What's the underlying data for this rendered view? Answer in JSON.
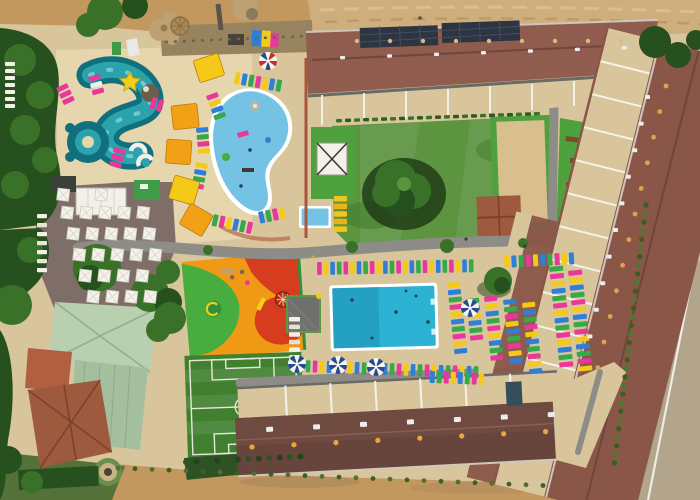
{
  "meta": {
    "title": "Aerial drone view of a holiday resort with water park, pools, playground, football pitch and apartment blocks",
    "view": "top-down"
  },
  "palette": {
    "sand": "#d9c59c",
    "sandlight": "#e6d6ae",
    "dirt": "#c2985f",
    "dirtlight": "#cfae7e",
    "scrub": "#55713a",
    "road": "#b3a48c",
    "path": "#8d8c86",
    "pave": "#7f6d68",
    "lawn": "#5d9440",
    "lawndark": "#3f7a2c",
    "turf": "#4fa13e",
    "pitch": "#40802f",
    "treedark": "#27501f",
    "treemid": "#3a7128",
    "shrub": "#3f6b2f",
    "riverdark": "#11707e",
    "river": "#2ba3ad",
    "riverlight": "#7fd0d6",
    "kidspool": "#74c2e4",
    "mainpool": "#2cb3d4",
    "mainpooldark": "#1f97b8",
    "rooftop": "#8f5c4d",
    "roofbottom": "#6f4a40",
    "roofright": "#8a5648",
    "roofpale1": "#b9d0b0",
    "roofpale2": "#a4bf9e",
    "rooftile": "#9d5a3e",
    "terracotta": "#b06040",
    "courttan": "#d9bf8e",
    "solar": "#2e3542",
    "playorange": "#ef9915",
    "playred": "#d63c1e",
    "playgreen": "#47ad3e",
    "white1": "#f2f0e8",
    "gray1": "#9a978f",
    "dark1": "#4a463e",
    "rock": "#bda173",
    "loungerpink": "#e8399b",
    "loungeryellow": "#f4c918",
    "loungerblue": "#2f7fd6",
    "loungergreen": "#35a94c",
    "umbrellaorange": "#f2a117",
    "pinwheelnavy": "#274b8f",
    "candyred": "#c42e2e"
  },
  "furniture": {
    "colors": [
      "#e8399b",
      "#f4c918",
      "#2f7fd6",
      "#35a94c"
    ],
    "strips": [
      {
        "name": "pool-top-row",
        "x": 317,
        "y": 262,
        "dx": 6.6,
        "count": 24,
        "w": 4.6,
        "h": 13,
        "rot": -1
      },
      {
        "name": "pool-bottom-row",
        "x": 299,
        "y": 360,
        "dx": 7,
        "count": 26,
        "w": 4.6,
        "h": 12,
        "rot": 2,
        "off": 2
      },
      {
        "name": "deck-east-col-1",
        "x": 447,
        "y": 283,
        "dy": 7.4,
        "count": 10,
        "w": 13,
        "h": 5,
        "rot": -6,
        "off": 1
      },
      {
        "name": "deck-east-col-2",
        "x": 466,
        "y": 299,
        "dy": 7.4,
        "count": 6,
        "w": 13,
        "h": 5,
        "rot": -6,
        "off": 3
      },
      {
        "name": "deck-east-col-3",
        "x": 484,
        "y": 297,
        "dy": 7.4,
        "count": 9,
        "w": 13,
        "h": 5,
        "rot": -6
      },
      {
        "name": "deck-east-col-4",
        "x": 503,
        "y": 300,
        "dy": 7.4,
        "count": 9,
        "w": 13,
        "h": 5,
        "rot": -6,
        "off": 2
      },
      {
        "name": "deck-east-col-5",
        "x": 522,
        "y": 303,
        "dy": 7.4,
        "count": 10,
        "w": 13,
        "h": 5,
        "rot": -6,
        "off": 1
      },
      {
        "name": "deck-east-col-6",
        "x": 549,
        "y": 267,
        "dy": 7.4,
        "count": 14,
        "w": 14,
        "h": 5,
        "rot": -6,
        "off": 3
      },
      {
        "name": "deck-east-col-7",
        "x": 568,
        "y": 271,
        "dy": 7.4,
        "count": 14,
        "w": 14,
        "h": 5,
        "rot": -6
      },
      {
        "name": "deck-east-top-row",
        "x": 504,
        "y": 256,
        "dx": 7.2,
        "count": 10,
        "w": 5,
        "h": 12,
        "rot": -3,
        "off": 1
      },
      {
        "name": "deck-southeast-row",
        "x": 430,
        "y": 371,
        "dx": 7,
        "count": 8,
        "w": 5,
        "h": 12,
        "rot": 2,
        "off": 2
      },
      {
        "name": "pool-west-white-col",
        "x": 289,
        "y": 317,
        "dy": 7.6,
        "count": 7,
        "w": 11,
        "h": 4.5,
        "colors": [
          "#f3f0e7",
          "#e4e0d2"
        ]
      },
      {
        "name": "toddler-pool-loungers",
        "x": 334,
        "y": 196,
        "dy": 7.6,
        "count": 5,
        "w": 13,
        "h": 5.5,
        "colors": [
          "#f2c41c",
          "#e9b514"
        ]
      },
      {
        "name": "kids-pool-top-arc",
        "x": 236,
        "y": 72,
        "dx": 7,
        "count": 7,
        "w": 5,
        "h": 12,
        "rot": 10,
        "off": 1
      },
      {
        "name": "kids-pool-left-arc-1",
        "x": 206,
        "y": 96,
        "dy": 7,
        "count": 4,
        "w": 12,
        "h": 5,
        "rot": -20
      },
      {
        "name": "kids-pool-left-arc-2",
        "x": 196,
        "y": 128,
        "dy": 7,
        "count": 4,
        "w": 12,
        "h": 5,
        "rot": -5,
        "off": 2
      },
      {
        "name": "kids-pool-left-arc-3",
        "x": 196,
        "y": 162,
        "dy": 7,
        "count": 4,
        "w": 12,
        "h": 5,
        "rot": 10,
        "off": 1
      },
      {
        "name": "kids-pool-bottom-arc",
        "x": 214,
        "y": 214,
        "dx": 7,
        "count": 6,
        "w": 5,
        "h": 12,
        "rot": 12,
        "off": 3
      },
      {
        "name": "kids-pool-bottom-arc-2",
        "x": 258,
        "y": 212,
        "dx": 7,
        "count": 4,
        "w": 5,
        "h": 12,
        "rot": -12,
        "off": 2
      },
      {
        "name": "waterpark-loungers-1",
        "x": 56,
        "y": 88,
        "dy": 7,
        "count": 3,
        "w": 12,
        "h": 5,
        "rot": -25,
        "colors": [
          "#e8399b"
        ]
      },
      {
        "name": "waterpark-loungers-2",
        "x": 88,
        "y": 77,
        "dy": 7,
        "count": 3,
        "w": 12,
        "h": 5,
        "rot": -15,
        "colors": [
          "#e8399b",
          "#f3f0e7"
        ]
      },
      {
        "name": "waterpark-loungers-3",
        "x": 114,
        "y": 147,
        "dy": 7,
        "count": 3,
        "w": 12,
        "h": 5,
        "rot": 15,
        "colors": [
          "#e8399b"
        ]
      },
      {
        "name": "waterpark-loungers-4",
        "x": 149,
        "y": 108,
        "dy": 7,
        "count": 2,
        "w": 12,
        "h": 5,
        "rot": -70,
        "colors": [
          "#e8399b"
        ]
      },
      {
        "name": "westside-white-col",
        "x": 5,
        "y": 62,
        "dy": 7,
        "count": 7,
        "w": 10,
        "h": 4,
        "colors": [
          "#f3f0e7"
        ]
      },
      {
        "name": "terrace-sunbed-col",
        "x": 37,
        "y": 214,
        "dy": 9,
        "count": 7,
        "w": 10,
        "h": 4.2,
        "colors": [
          "#f3f0e7",
          "#e8e4d6"
        ]
      },
      {
        "name": "lawn-hedge-row",
        "x": 336,
        "y": 119,
        "dx": 9,
        "count": 23,
        "w": 6,
        "h": 3.5,
        "rot": -2,
        "colors": [
          "#3a7128",
          "#2c5a20"
        ]
      },
      {
        "name": "vents-north",
        "x": 357,
        "y": 41,
        "dx": 33,
        "count": 9,
        "r": 2.2,
        "colors": [
          "#d9b97c"
        ]
      },
      {
        "name": "ac-units-north",
        "x": 340,
        "y": 56,
        "dx": 47,
        "count": 7,
        "w": 5,
        "h": 3.4,
        "rot": -2,
        "colors": [
          "#ececec"
        ]
      },
      {
        "name": "vents-south",
        "x": 252,
        "y": 447,
        "dx": 42,
        "count": 8,
        "r": 2.6,
        "rot": -3,
        "colors": [
          "#e8a83c"
        ]
      },
      {
        "name": "ac-units-south",
        "x": 266,
        "y": 427,
        "dx": 47,
        "count": 7,
        "w": 7,
        "h": 5,
        "rot": -3,
        "colors": [
          "#ececec"
        ]
      },
      {
        "name": "vents-east",
        "x": 666,
        "y": 86,
        "dx": -6.2,
        "dy": 25.6,
        "count": 12,
        "r": 2.4,
        "colors": [
          "#e0a34c"
        ]
      },
      {
        "name": "ac-units-east",
        "x": 645,
        "y": 95,
        "dx": -6.4,
        "dy": 26.6,
        "count": 10,
        "w": 5,
        "h": 4,
        "colors": [
          "#ececec"
        ]
      },
      {
        "name": "scrub-dots-south",
        "x": 118,
        "y": 468,
        "dx": 17,
        "dy": 0.7,
        "count": 26,
        "r": 2.4,
        "colors": [
          "#4f6f36",
          "#3f5c2b"
        ]
      },
      {
        "name": "shrub-dots-east",
        "x": 646,
        "y": 205,
        "dx": -1.05,
        "dy": 8.6,
        "count": 31,
        "r": 2.6,
        "colors": [
          "#35601f",
          "#4a7a30"
        ]
      },
      {
        "name": "pitch-hedge-dots",
        "x": 186,
        "y": 462,
        "dx": 10.4,
        "dy": -0.5,
        "count": 12,
        "r": 3,
        "colors": [
          "#2e5223",
          "#24451b"
        ]
      }
    ],
    "canopies": [
      {
        "x": 193,
        "y": 61,
        "w": 26,
        "h": 23,
        "rot": -18,
        "color": "#f4c918"
      },
      {
        "x": 171,
        "y": 106,
        "w": 26,
        "h": 24,
        "rot": -6,
        "color": "#f2a117"
      },
      {
        "x": 167,
        "y": 139,
        "w": 25,
        "h": 24,
        "rot": 4,
        "color": "#f2a117"
      },
      {
        "x": 175,
        "y": 175,
        "w": 26,
        "h": 24,
        "rot": 16,
        "color": "#f4c918"
      },
      {
        "x": 191,
        "y": 203,
        "w": 26,
        "h": 24,
        "rot": 30,
        "color": "#f2a117"
      }
    ],
    "umbrella_grid": {
      "size": 12,
      "rot": 7,
      "rows": [
        {
          "x": 58,
          "y": 188,
          "dx": 38,
          "count": 2
        },
        {
          "x": 62,
          "y": 206,
          "dx": 19,
          "count": 5
        },
        {
          "x": 68,
          "y": 227,
          "dx": 19,
          "count": 5
        },
        {
          "x": 74,
          "y": 248,
          "dx": 19,
          "count": 5
        },
        {
          "x": 80,
          "y": 269,
          "dx": 19,
          "count": 4
        },
        {
          "x": 88,
          "y": 290,
          "dx": 19,
          "count": 4
        }
      ]
    },
    "pinwheels": [
      {
        "x": 297,
        "y": 364,
        "r": 9
      },
      {
        "x": 338,
        "y": 365,
        "r": 9
      },
      {
        "x": 376,
        "y": 367,
        "r": 9
      },
      {
        "x": 470,
        "y": 308,
        "r": 9
      },
      {
        "x": 268,
        "y": 61,
        "r": 9,
        "candy": true
      }
    ],
    "dots": [
      {
        "x": 352,
        "y": 300,
        "r": 1.8,
        "c": "#27414f"
      },
      {
        "x": 396,
        "y": 312,
        "r": 1.8,
        "c": "#27414f"
      },
      {
        "x": 416,
        "y": 296,
        "r": 1.5,
        "c": "#27414f"
      },
      {
        "x": 372,
        "y": 338,
        "r": 1.5,
        "c": "#27414f"
      },
      {
        "x": 428,
        "y": 322,
        "r": 1.8,
        "c": "#27414f"
      },
      {
        "x": 406,
        "y": 291,
        "r": 1.4,
        "c": "#27414f"
      },
      {
        "x": 466,
        "y": 239,
        "r": 1.6,
        "c": "#3a3a3a"
      },
      {
        "x": 525,
        "y": 246,
        "r": 1.6,
        "c": "#3a3a3a"
      },
      {
        "x": 313,
        "y": 257,
        "r": 1.6,
        "c": "#c2b43c"
      },
      {
        "x": 420,
        "y": 18,
        "r": 1.8,
        "c": "#555048"
      }
    ]
  }
}
